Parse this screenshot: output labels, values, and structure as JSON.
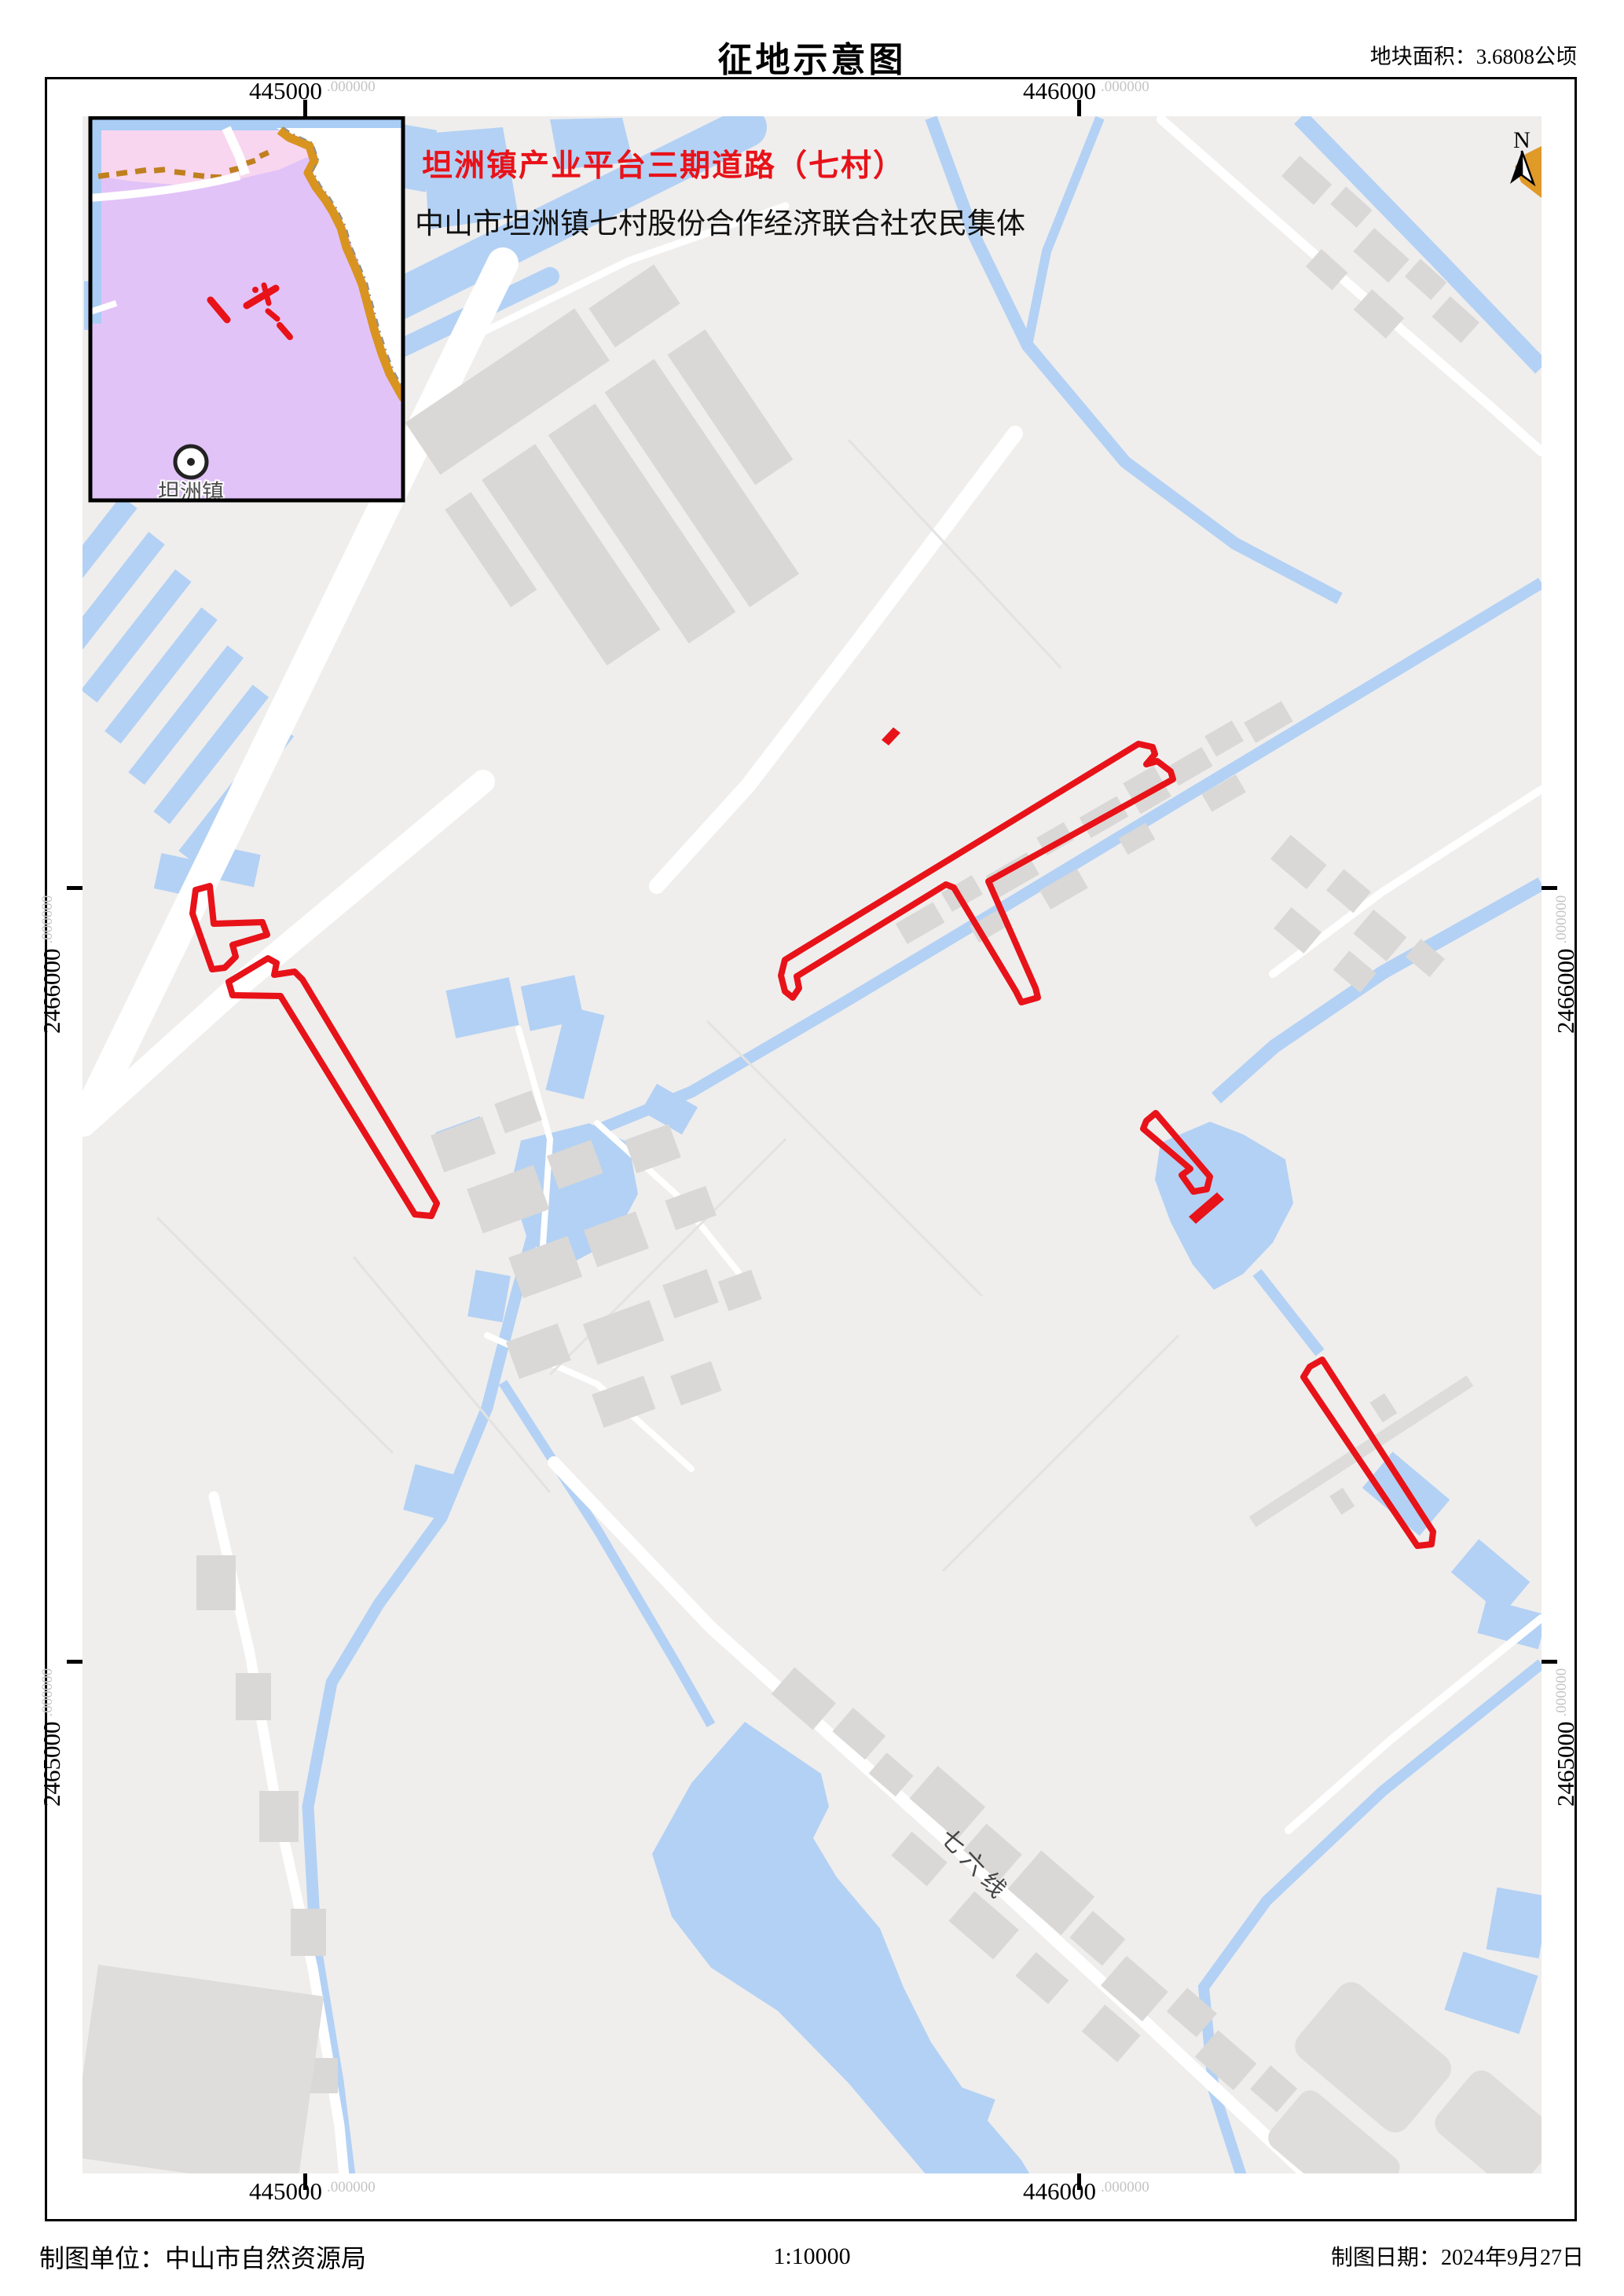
{
  "sheet": {
    "title": "征地示意图",
    "area_label": "地块面积：3.6808公顷"
  },
  "project": {
    "red_title": "坦洲镇产业平台三期道路（七村）",
    "owner": "中山市坦洲镇七村股份合作经济联合社农民集体"
  },
  "inset": {
    "town_label": "坦洲镇"
  },
  "map": {
    "road_label": "七六线",
    "north_label": "N"
  },
  "grid": {
    "x_left": "445000",
    "x_right": "446000",
    "y_upper": "2466000",
    "y_lower": "2465000",
    "decimals": ".000000"
  },
  "footer": {
    "agency": "制图单位：中山市自然资源局",
    "scale": "1:10000",
    "date": "制图日期：2024年9月27日"
  },
  "colors": {
    "red": "#e81219",
    "water": "#b3d1f4",
    "building": "#d9d8d6",
    "road": "#ffffff",
    "bg": "#efeeed",
    "inset_pink": "#f8d6ef",
    "inset_purple": "#e2c3f8",
    "inset_orange": "#d8941f",
    "inset_blue": "#a9cdf4"
  }
}
